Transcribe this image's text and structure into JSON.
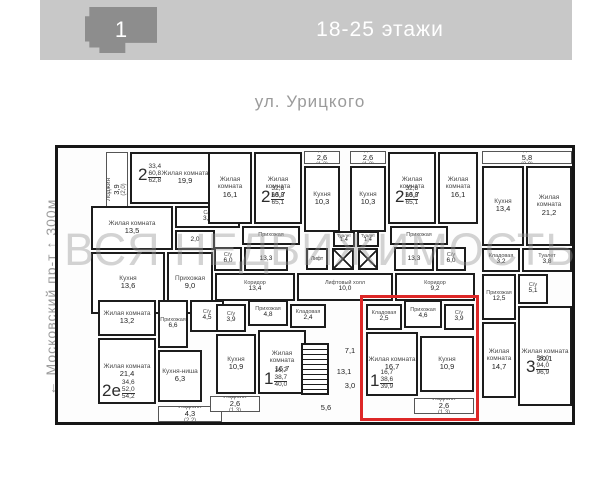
{
  "header": {
    "building_number": "1",
    "floors_label": "18-25 этажи"
  },
  "street_label": "ул. Урицкого",
  "side_label": "← Московский пр-т ↑ 300м",
  "watermark": "ВСЯ НЕДВИЖИМОСТЬ",
  "colors": {
    "header_bg": "#c8c8c8",
    "building_icon": "#8d8d8d",
    "muted_text": "#9b9b9b",
    "wall": "#161616",
    "highlight": "#dd2727",
    "watermark": "#969696"
  },
  "plan": {
    "rooms": [
      {
        "id": "loggia-apt1",
        "label": "Лоджия",
        "area": "3,9",
        "area2": "(2,0)",
        "x": 48,
        "y": 4,
        "w": 22,
        "h": 74,
        "cls": "loggia vert"
      },
      {
        "id": "living-19-9",
        "label": "Жилая комната",
        "area": "19,9",
        "x": 72,
        "y": 4,
        "w": 110,
        "h": 52
      },
      {
        "id": "living-13-5",
        "label": "Жилая комната",
        "area": "13,5",
        "x": 33,
        "y": 58,
        "w": 82,
        "h": 44
      },
      {
        "id": "wc-3-2",
        "label": "С/у",
        "area": "3,2",
        "x": 117,
        "y": 58,
        "w": 65,
        "h": 22,
        "cls": "small"
      },
      {
        "id": "wc-2-0",
        "label": "",
        "area": "2,0",
        "x": 117,
        "y": 82,
        "w": 40,
        "h": 20,
        "cls": "small"
      },
      {
        "id": "kitchen-13-6",
        "label": "Кухня",
        "area": "13,6",
        "x": 33,
        "y": 104,
        "w": 74,
        "h": 62
      },
      {
        "id": "hall-9-0",
        "label": "Прихожая",
        "area": "9,0",
        "x": 109,
        "y": 104,
        "w": 46,
        "h": 62
      },
      {
        "id": "living-16-1-a",
        "label": "Жилая комната",
        "area": "16,1",
        "x": 150,
        "y": 4,
        "w": 44,
        "h": 72
      },
      {
        "id": "living-16-7-a",
        "label": "Жилая комната",
        "area": "16,7",
        "x": 196,
        "y": 4,
        "w": 48,
        "h": 72
      },
      {
        "id": "loggia-2-6-a",
        "label": "Лоджия",
        "area": "2,6",
        "area2": "(1,3)",
        "x": 246,
        "y": 3,
        "w": 36,
        "h": 13,
        "cls": "loggia"
      },
      {
        "id": "kitchen-10-3-a",
        "label": "Кухня",
        "area": "10,3",
        "x": 246,
        "y": 18,
        "w": 36,
        "h": 66
      },
      {
        "id": "hall-a",
        "label": "Прихожая",
        "area": "",
        "x": 184,
        "y": 78,
        "w": 58,
        "h": 19,
        "cls": "small"
      },
      {
        "id": "wc-6-0-a",
        "label": "С/у",
        "area": "6,0",
        "x": 156,
        "y": 99,
        "w": 28,
        "h": 24,
        "cls": "small"
      },
      {
        "id": "room-13-3-a",
        "label": "",
        "area": "13,3",
        "x": 186,
        "y": 99,
        "w": 44,
        "h": 24,
        "cls": "small"
      },
      {
        "id": "toilet-1-4-a",
        "label": "Туалет",
        "area": "1,4",
        "x": 275,
        "y": 83,
        "w": 22,
        "h": 16,
        "cls": "tiny"
      },
      {
        "id": "toilet-1-4-b",
        "label": "Туалет",
        "area": "1,4",
        "x": 299,
        "y": 83,
        "w": 22,
        "h": 16,
        "cls": "tiny"
      },
      {
        "id": "loggia-2-6-b",
        "label": "Лоджия",
        "area": "2,6",
        "area2": "(1,3)",
        "x": 292,
        "y": 3,
        "w": 36,
        "h": 13,
        "cls": "loggia"
      },
      {
        "id": "kitchen-10-3-b",
        "label": "Кухня",
        "area": "10,3",
        "x": 292,
        "y": 18,
        "w": 36,
        "h": 66
      },
      {
        "id": "living-16-7-b",
        "label": "Жилая комната",
        "area": "16,7",
        "x": 330,
        "y": 4,
        "w": 48,
        "h": 72
      },
      {
        "id": "living-16-1-b",
        "label": "Жилая комната",
        "area": "16,1",
        "x": 380,
        "y": 4,
        "w": 40,
        "h": 72
      },
      {
        "id": "hall-b",
        "label": "Прихожая",
        "area": "",
        "x": 332,
        "y": 78,
        "w": 58,
        "h": 19,
        "cls": "small"
      },
      {
        "id": "room-13-3-b",
        "label": "",
        "area": "13,3",
        "x": 336,
        "y": 99,
        "w": 40,
        "h": 24,
        "cls": "small"
      },
      {
        "id": "wc-6-0-b",
        "label": "С/у",
        "area": "6,0",
        "x": 378,
        "y": 99,
        "w": 30,
        "h": 24,
        "cls": "small"
      },
      {
        "id": "loggia-5-8",
        "label": "Лоджия",
        "area": "5,8",
        "area2": "(2,9)",
        "x": 424,
        "y": 3,
        "w": 90,
        "h": 13,
        "cls": "loggia"
      },
      {
        "id": "kitchen-13-4",
        "label": "Кухня",
        "area": "13,4",
        "x": 424,
        "y": 18,
        "w": 42,
        "h": 80
      },
      {
        "id": "living-21-2",
        "label": "Жилая комната",
        "area": "21,2",
        "x": 468,
        "y": 18,
        "w": 46,
        "h": 80
      },
      {
        "id": "storage-3-2",
        "label": "Кладовая",
        "area": "3,2",
        "x": 424,
        "y": 100,
        "w": 38,
        "h": 24,
        "cls": "small"
      },
      {
        "id": "toilet-3-8",
        "label": "Туалет",
        "area": "3,8",
        "x": 464,
        "y": 100,
        "w": 50,
        "h": 24,
        "cls": "small"
      },
      {
        "id": "hall-12-5",
        "label": "Прихожая",
        "area": "12,5",
        "x": 424,
        "y": 126,
        "w": 34,
        "h": 46,
        "cls": "small"
      },
      {
        "id": "wc-5-1",
        "label": "С/у",
        "area": "5,1",
        "x": 460,
        "y": 126,
        "w": 30,
        "h": 30,
        "cls": "small"
      },
      {
        "id": "living-14-7",
        "label": "Жилая комната",
        "area": "14,7",
        "x": 424,
        "y": 174,
        "w": 34,
        "h": 76
      },
      {
        "id": "living-20-1",
        "label": "Жилая комната",
        "area": "20,1",
        "x": 460,
        "y": 158,
        "w": 54,
        "h": 100
      },
      {
        "id": "corridor-13-4",
        "label": "Коридор",
        "area": "13,4",
        "x": 157,
        "y": 125,
        "w": 80,
        "h": 28,
        "cls": "small"
      },
      {
        "id": "lift-hall-10-0",
        "label": "Лифтовый холл",
        "area": "10,0",
        "x": 239,
        "y": 125,
        "w": 96,
        "h": 28,
        "cls": "small"
      },
      {
        "id": "corridor-9-2",
        "label": "Коридор",
        "area": "9,2",
        "x": 337,
        "y": 125,
        "w": 80,
        "h": 28,
        "cls": "small"
      },
      {
        "id": "stairs-13-1",
        "label": "",
        "area": "13,1",
        "x": 272,
        "y": 216,
        "w": 28,
        "h": 16,
        "cls": "bare"
      },
      {
        "id": "lobby-7-1",
        "label": "",
        "area": "7,1",
        "x": 284,
        "y": 195,
        "w": 16,
        "h": 16,
        "cls": "bare"
      },
      {
        "id": "lobby-3-0",
        "label": "",
        "area": "3,0",
        "x": 284,
        "y": 230,
        "w": 16,
        "h": 16,
        "cls": "bare"
      },
      {
        "id": "lobby-5-6",
        "label": "",
        "area": "5,6",
        "x": 248,
        "y": 252,
        "w": 40,
        "h": 16,
        "cls": "bare"
      },
      {
        "id": "living-13-2",
        "label": "Жилая комната",
        "area": "13,2",
        "x": 40,
        "y": 152,
        "w": 58,
        "h": 36
      },
      {
        "id": "hall-6-6",
        "label": "Прихожая",
        "area": "6,6",
        "x": 100,
        "y": 152,
        "w": 30,
        "h": 48,
        "cls": "small"
      },
      {
        "id": "wc-4-5",
        "label": "С/у",
        "area": "4,5",
        "x": 132,
        "y": 152,
        "w": 34,
        "h": 32,
        "cls": "small"
      },
      {
        "id": "living-21-4",
        "label": "Жилая комната",
        "area": "21,4",
        "x": 40,
        "y": 190,
        "w": 58,
        "h": 66
      },
      {
        "id": "kitchen-niche-6-3",
        "label": "Кухня-ниша",
        "area": "6,3",
        "x": 100,
        "y": 202,
        "w": 44,
        "h": 52
      },
      {
        "id": "loggia-4-3",
        "label": "Лоджия",
        "area": "4,3",
        "area2": "(2,2)",
        "x": 100,
        "y": 258,
        "w": 64,
        "h": 16,
        "cls": "loggia"
      },
      {
        "id": "wc-3-9-a",
        "label": "С/у",
        "area": "3,9",
        "x": 158,
        "y": 156,
        "w": 30,
        "h": 28,
        "cls": "small"
      },
      {
        "id": "hall-4-8",
        "label": "Прихожая",
        "area": "4,8",
        "x": 190,
        "y": 152,
        "w": 40,
        "h": 26,
        "cls": "small"
      },
      {
        "id": "storage-2-4",
        "label": "Кладовая",
        "area": "2,4",
        "x": 232,
        "y": 156,
        "w": 36,
        "h": 24,
        "cls": "small"
      },
      {
        "id": "kitchen-10-9-a",
        "label": "Кухня",
        "area": "10,9",
        "x": 158,
        "y": 186,
        "w": 40,
        "h": 60
      },
      {
        "id": "living-16-7-c",
        "label": "Жилая комната",
        "area": "16,7",
        "x": 200,
        "y": 182,
        "w": 48,
        "h": 64
      },
      {
        "id": "loggia-2-6-c",
        "label": "Лоджия",
        "area": "2,6",
        "area2": "(1,3)",
        "x": 152,
        "y": 248,
        "w": 50,
        "h": 16,
        "cls": "loggia"
      },
      {
        "id": "storage-2-5",
        "label": "Кладовая",
        "area": "2,5",
        "x": 308,
        "y": 156,
        "w": 36,
        "h": 26,
        "cls": "small"
      },
      {
        "id": "hall-4-6",
        "label": "Прихожая",
        "area": "4,6",
        "x": 346,
        "y": 152,
        "w": 38,
        "h": 28,
        "cls": "small"
      },
      {
        "id": "wc-3-9-b",
        "label": "С/у",
        "area": "3,9",
        "x": 386,
        "y": 156,
        "w": 30,
        "h": 26,
        "cls": "small"
      },
      {
        "id": "living-16-7-d",
        "label": "Жилая комната",
        "area": "16,7",
        "x": 308,
        "y": 184,
        "w": 52,
        "h": 64
      },
      {
        "id": "kitchen-10-9-b",
        "label": "Кухня",
        "area": "10,9",
        "x": 362,
        "y": 188,
        "w": 54,
        "h": 56
      },
      {
        "id": "loggia-2-6-d",
        "label": "Лоджия",
        "area": "2,6",
        "area2": "(1,3)",
        "x": 356,
        "y": 250,
        "w": 60,
        "h": 16,
        "cls": "loggia"
      }
    ],
    "badges": [
      {
        "id": "apt-2",
        "num": "2",
        "values": [
          "33,4",
          "60,8",
          "62,8"
        ],
        "x": 80,
        "y": 16
      },
      {
        "id": "apt-2-left",
        "num": "2",
        "values": [
          "32,8",
          "63,8",
          "65,1"
        ],
        "x": 203,
        "y": 38
      },
      {
        "id": "apt-2-right",
        "num": "2",
        "values": [
          "32,8",
          "63,8",
          "65,1"
        ],
        "x": 337,
        "y": 38
      },
      {
        "id": "apt-3",
        "num": "3",
        "values": [
          "56,0",
          "94,0",
          "96,9"
        ],
        "x": 468,
        "y": 208
      },
      {
        "id": "apt-2e",
        "num": "2е",
        "values": [
          "34,6",
          "52,0",
          "54,2"
        ],
        "x": 44,
        "y": 232
      },
      {
        "id": "apt-1-left",
        "num": "1",
        "values": [
          "16,7",
          "38,7",
          "40,0"
        ],
        "x": 206,
        "y": 220
      },
      {
        "id": "apt-1-right",
        "num": "1",
        "values": [
          "16,7",
          "38,6",
          "39,9"
        ],
        "x": 312,
        "y": 222
      }
    ],
    "elevators": {
      "cabinet_label": "Лифт",
      "cabinet": {
        "x": 248,
        "y": 100,
        "w": 22,
        "h": 22
      },
      "shafts": [
        {
          "x": 274,
          "y": 100,
          "w": 22,
          "h": 22
        },
        {
          "x": 300,
          "y": 100,
          "w": 20,
          "h": 22
        }
      ]
    },
    "stairs": {
      "x": 243,
      "y": 195,
      "w": 28,
      "h": 52
    },
    "highlight": {
      "x": 302,
      "y": 147,
      "w": 119,
      "h": 126
    }
  }
}
